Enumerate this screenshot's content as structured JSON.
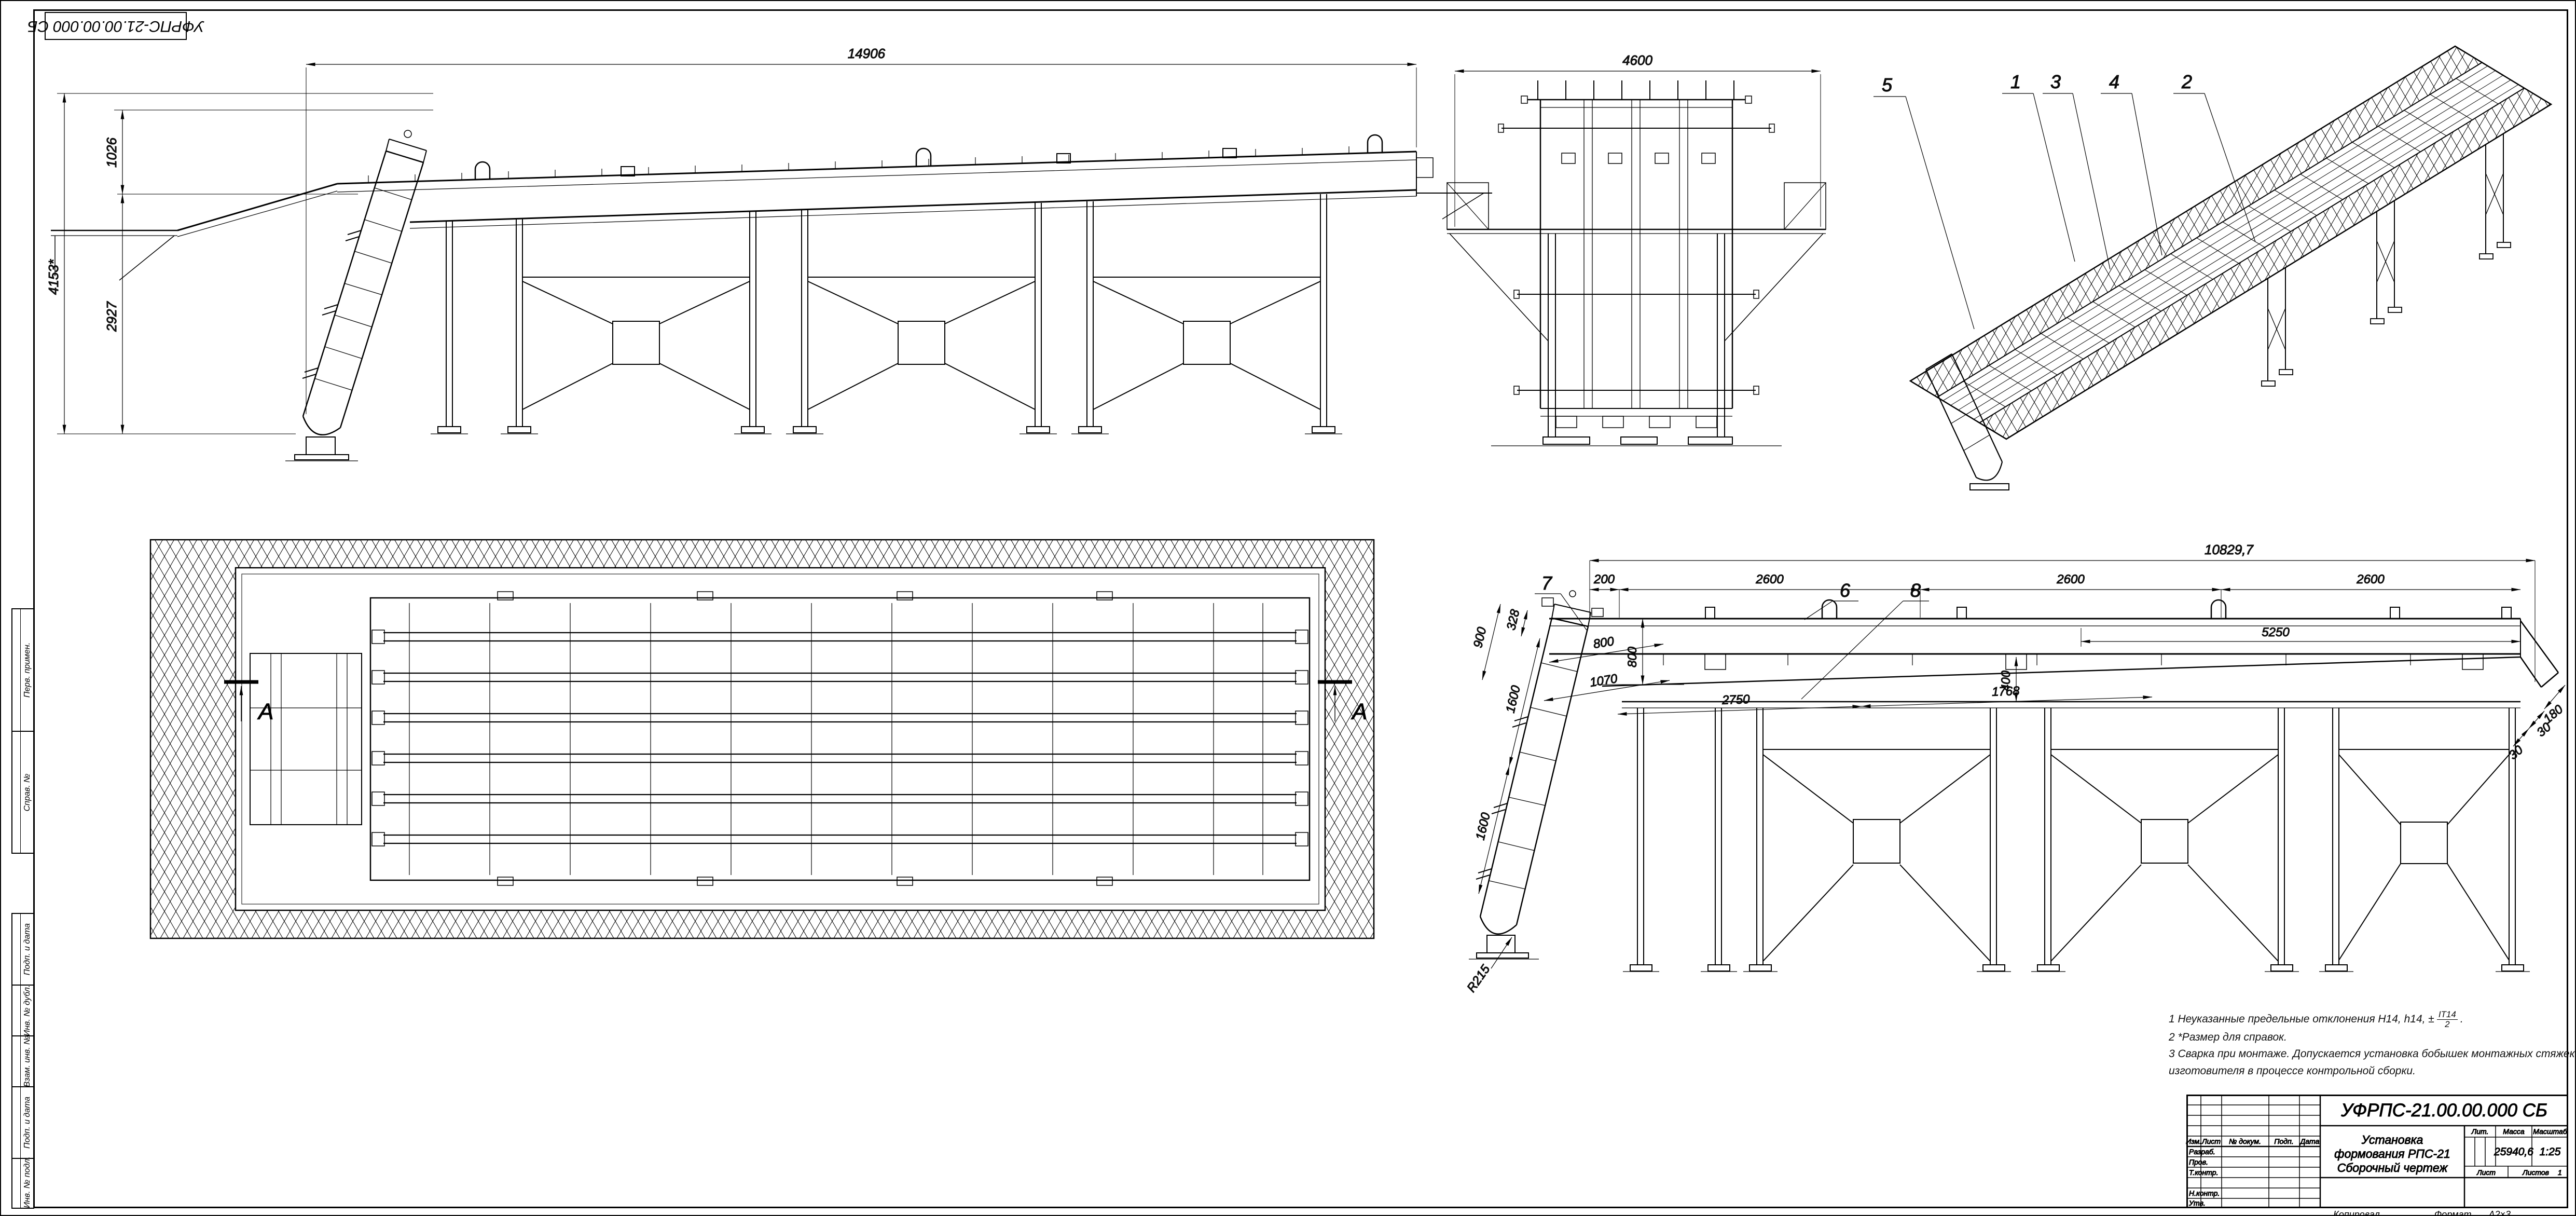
{
  "sheet": {
    "corner_stamp": "УФРПС-21.00.00.000 СБ",
    "margin_labels": {
      "perv_primen": "Перв. примен.",
      "sprav_no": "Справ. №",
      "podp_data_1": "Подп. и дата",
      "inv_no_dubl": "Инв. № дубл.",
      "vzam_inv_no": "Взам. инв. №",
      "podp_data_2": "Подп. и дата",
      "inv_no_podl": "Инв. № подл."
    },
    "footer": {
      "copied": "Копировал",
      "format_label": "Формат",
      "format_value": "А2×3"
    }
  },
  "views": {
    "side_main": {
      "dim_length": "14906",
      "dim_height_overall": "4153*",
      "dim_h_upper": "1026",
      "dim_h_lower": "2927"
    },
    "front": {
      "dim_width": "4600"
    },
    "iso": {
      "callout_5": "5",
      "callout_1": "1",
      "callout_3": "3",
      "callout_4": "4",
      "callout_2": "2"
    },
    "plan": {
      "section_left": "А",
      "section_right": "А"
    },
    "side_detail": {
      "dim_overall": "10829,7",
      "dim_200": "200",
      "dim_2600_1": "2600",
      "dim_2600_2": "2600",
      "dim_2600_3": "2600",
      "dim_5250": "5250",
      "dim_800_v": "800",
      "dim_400": "400",
      "dim_900": "900",
      "dim_328": "328",
      "dim_1600_1": "1600",
      "dim_1600_2": "1600",
      "dim_800_s": "800",
      "dim_1070": "1070",
      "dim_2750": "2750",
      "dim_1768": "1768",
      "dim_r215": "R215",
      "dim_180": "180",
      "dim_30_1": "30",
      "dim_30_2": "30",
      "callout_6": "6",
      "callout_7": "7",
      "callout_8": "8"
    }
  },
  "notes": {
    "n1_prefix": "1  Неуказанные предельные отклонения Н14, h14, ±",
    "n1_frac_num": "IT14",
    "n1_frac_den": "2",
    "n1_suffix": ".",
    "n2": "2  *Размер для справок.",
    "n3a": "3  Сварка при монтаже. Допускается установка бобышек монтажных стяжек силами предприятия",
    "n3b": "изготовителя в процессе контрольной сборки."
  },
  "title_block": {
    "designation": "УФРПС-21.00.00.000 СБ",
    "name_line1": "Установка",
    "name_line2": "формования РПС-21",
    "name_line3": "Сборочный чертеж",
    "col_izm": "Изм.",
    "col_list": "Лист",
    "col_doc": "№ докум.",
    "col_podp": "Подп.",
    "col_data": "Дата",
    "row_razrab": "Разраб.",
    "row_prov": "Пров.",
    "row_tkontr": "Т.контр.",
    "row_nkontr": "Н.контр.",
    "row_utv": "Утв.",
    "lit_header": "Лит.",
    "mass_header": "Масса",
    "scale_header": "Масштаб",
    "mass_value": "25940,6",
    "scale_value": "1:25",
    "sheet_label": "Лист",
    "sheets_label": "Листов",
    "sheets_value": "1"
  }
}
